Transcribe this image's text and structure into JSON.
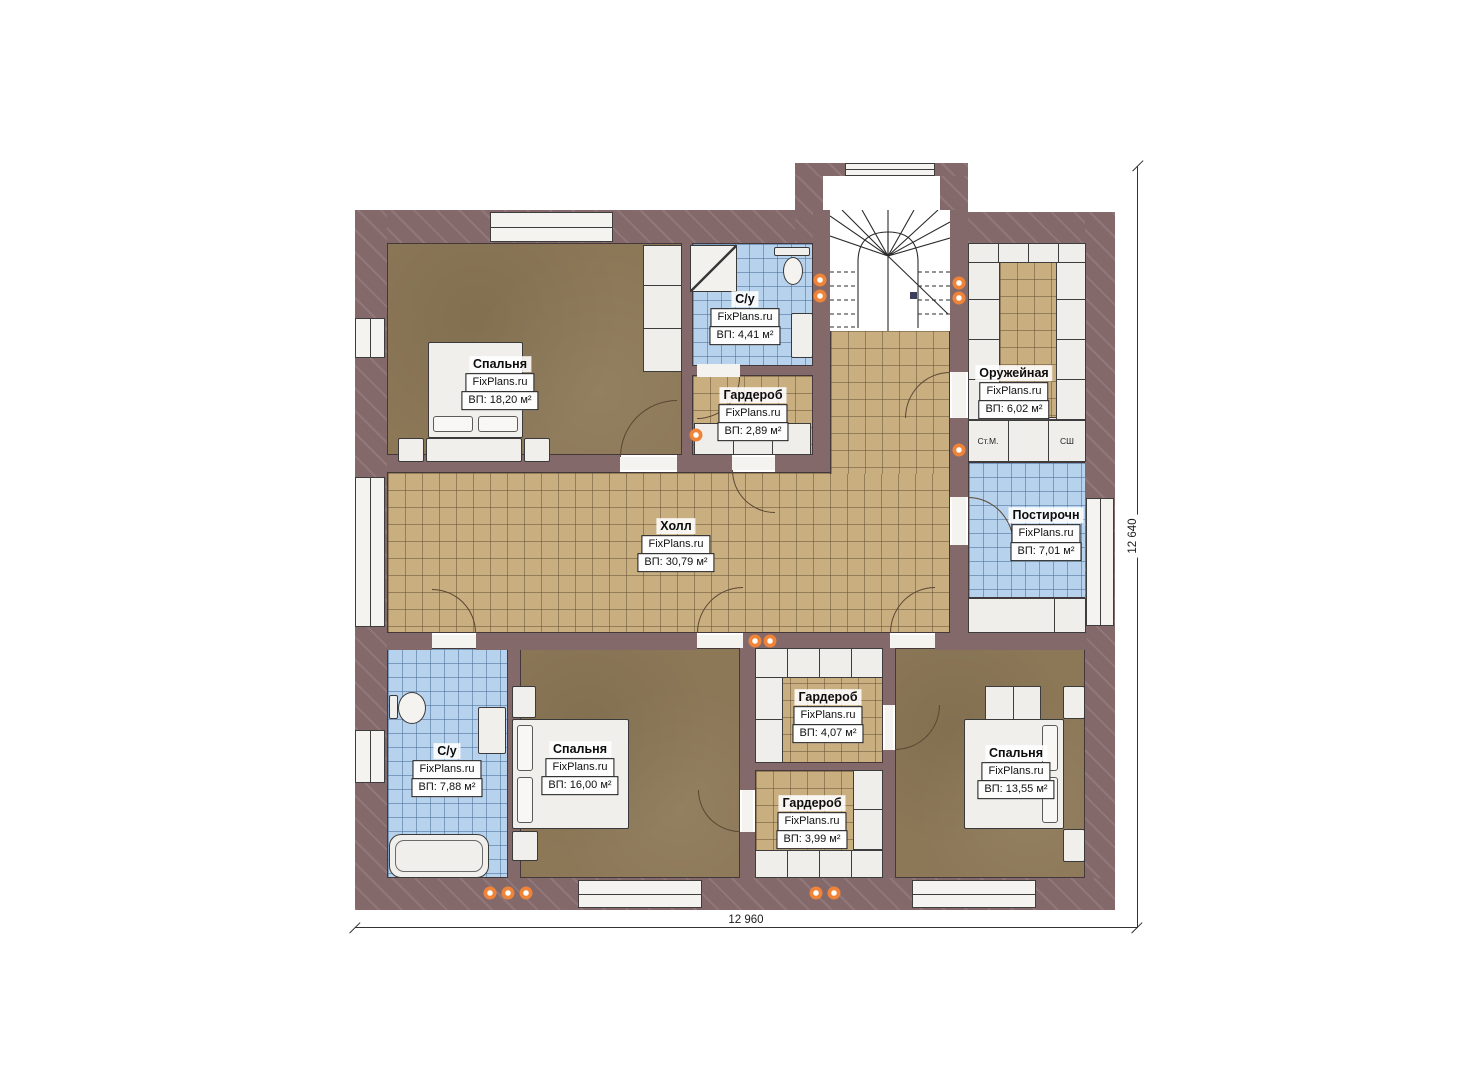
{
  "watermark": "FixPlans.ru",
  "rooms": [
    {
      "id": "bedroom-top-left",
      "name": "Спальня",
      "area": "ВП: 18,20 м²"
    },
    {
      "id": "bathroom-top",
      "name": "С/у",
      "area": "ВП: 4,41 м²"
    },
    {
      "id": "wardrobe-top",
      "name": "Гардероб",
      "area": "ВП: 2,89 м²"
    },
    {
      "id": "armory",
      "name": "Оружейная",
      "area": "ВП: 6,02 м²"
    },
    {
      "id": "hall",
      "name": "Холл",
      "area": "ВП: 30,79 м²"
    },
    {
      "id": "laundry",
      "name": "Постирочн",
      "area": "ВП: 7,01 м²"
    },
    {
      "id": "bathroom-bottom",
      "name": "С/у",
      "area": "ВП: 7,88 м²"
    },
    {
      "id": "bedroom-bottom-center",
      "name": "Спальня",
      "area": "ВП: 16,00 м²"
    },
    {
      "id": "wardrobe-mid-upper",
      "name": "Гардероб",
      "area": "ВП: 4,07 м²"
    },
    {
      "id": "wardrobe-mid-lower",
      "name": "Гардероб",
      "area": "ВП: 3,99 м²"
    },
    {
      "id": "bedroom-bottom-right",
      "name": "Спальня",
      "area": "ВП: 13,55 м²"
    }
  ],
  "appliances": {
    "washing_machine": "Ст.М.",
    "drying_cabinet": "СШ"
  },
  "dimensions": {
    "width": "12 960",
    "height": "12 640"
  },
  "colors": {
    "wall": "#84696b",
    "floor_wood": "#8c7857",
    "tile_tan": "#c9ae80",
    "tile_blue": "#b7d2ec",
    "fixture_white": "#f0efeb",
    "accent_dot": "#ef8338"
  }
}
